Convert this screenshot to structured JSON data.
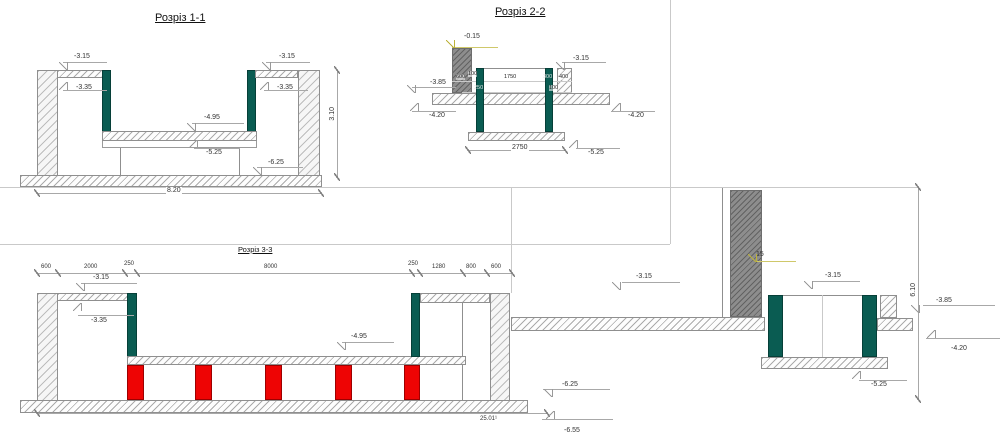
{
  "s11": {
    "title": "Розріз 1-1",
    "lv_top_left": "-3.15",
    "lv_mid_left": "-3.35",
    "lv_slab_top": "-4.95",
    "lv_slab_bot": "-5.25",
    "lv_base": "-6.25",
    "lv_top_right": "-3.15",
    "lv_mid_right": "-3.35",
    "dim_height": "3.10",
    "dim_width": "8.20"
  },
  "s22": {
    "title": "Розріз 2-2",
    "lv_top": "-0.15",
    "lv_right_top": "-3.15",
    "lv_left_top": "-3.85",
    "lv_left_bot": "-4.20",
    "lv_right_bot": "-4.20",
    "lv_base": "-5.25",
    "d_600": "600",
    "d_100a": "100",
    "d_1750": "1750",
    "d_300": "300",
    "d_400": "400",
    "d_250": "250",
    "d_100b": "100",
    "d_width": "2750"
  },
  "s33": {
    "title": "Розріз 3-3",
    "top_dims": [
      "600",
      "2000",
      "250",
      "8000",
      "250",
      "1280",
      "800",
      "600"
    ],
    "lv_top": "-3.15",
    "lv_mid": "-3.35",
    "lv_slab": "-4.95",
    "dim_width": "25.01¹"
  },
  "rv": {
    "lv_col": "15",
    "lv_left": "-3.15",
    "lv_right": "-3.15",
    "lv_slab_top": "-3.85",
    "lv_slab_bot": "-4.20",
    "lv_base": "-5.25",
    "lv_found_top": "-6.25",
    "lv_found_bot": "-6.55",
    "dim_height": "6.10"
  },
  "colors": {
    "teal_column": "#0a5c52",
    "red_column": "#ee0404",
    "gray_column": "#8d8d8d",
    "hatch_line": "#ababab",
    "dim_line": "#a8a8a8",
    "text": "#333333",
    "level_yellow": "#cfc86a"
  }
}
